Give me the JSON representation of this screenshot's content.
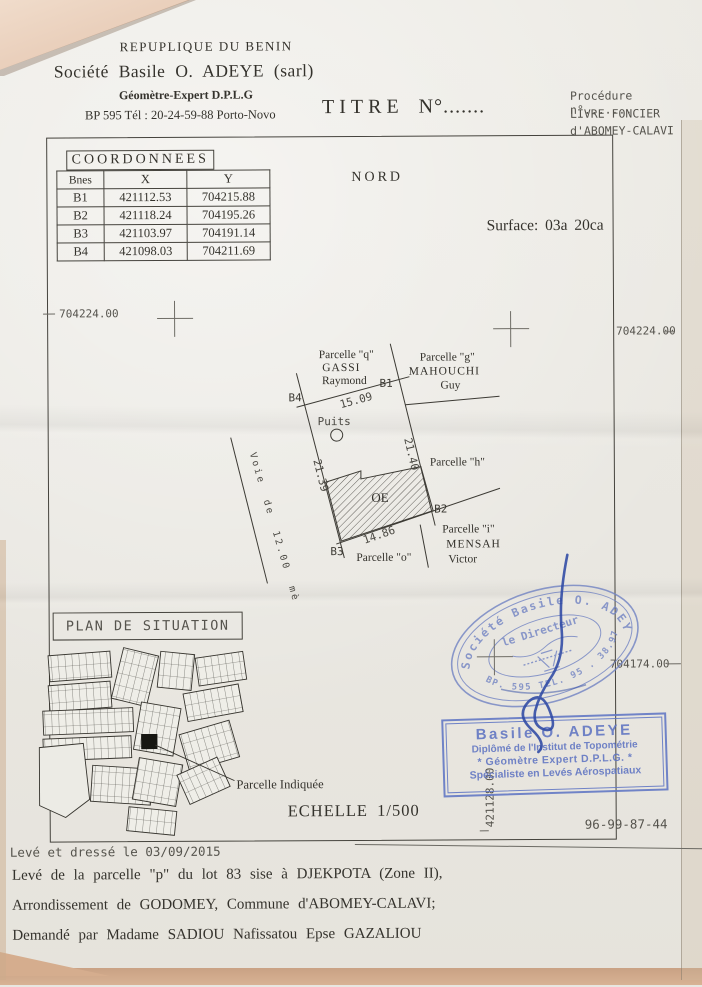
{
  "header": {
    "republic": "REPUPLIQUE DU BENIN",
    "company": "Société Basile O. ADEYE (sarl)",
    "profession": "Géomètre-Expert D.P.L.G",
    "address": "BP 595  Tél : 20-24-59-88  Porto-Novo",
    "title_main": "TITRE",
    "title_no": "N°.......",
    "procedure": "Procédure n°.......",
    "land_book_line1": "LIVRE FONCIER",
    "land_book_line2": "d'ABOMEY-CALAVI"
  },
  "coordinates_table": {
    "title": "COORDONNEES",
    "headers": [
      "Bnes",
      "X",
      "Y"
    ],
    "rows": [
      [
        "B1",
        "421112.53",
        "704215.88"
      ],
      [
        "B2",
        "421118.24",
        "704195.26"
      ],
      [
        "B3",
        "421103.97",
        "704191.14"
      ],
      [
        "B4",
        "421098.03",
        "704211.69"
      ]
    ]
  },
  "survey": {
    "north": "NORD",
    "surface": "Surface: 03a  20ca",
    "grid": {
      "top_left": "704224.00",
      "top_right": "704224.00",
      "mid_right": "704174.00",
      "bottom_vertical": "421128.00"
    },
    "parcel": {
      "b1": "B1",
      "b2": "B2",
      "b3": "B3",
      "b4": "B4",
      "dim_top": "15.09",
      "dim_left": "21.39",
      "dim_right": "21.40",
      "dim_bottom": "14.86",
      "well": "Puits",
      "building": "OE",
      "road": "Voie de 12.00 mètres",
      "neighbor_q": [
        "Parcelle \"q\"",
        "GASSI",
        "Raymond"
      ],
      "neighbor_g": [
        "Parcelle \"g\"",
        "MAHOUCHI",
        "Guy"
      ],
      "neighbor_h": "Parcelle \"h\"",
      "neighbor_i": [
        "Parcelle \"i\"",
        "MENSAH",
        "Victor"
      ],
      "neighbor_o": "Parcelle \"o\""
    }
  },
  "situation": {
    "title": "PLAN DE SITUATION",
    "indicated": "Parcelle Indiquée",
    "scale": "ECHELLE 1/500"
  },
  "reference": "96-99-87-44",
  "stamps": {
    "round": {
      "arc_top": "Société Basile O. ADEYE",
      "center": "le Directeur",
      "arc_bottom": "BP. 595 TEL. 95 . 38.97"
    },
    "rect": {
      "name": "Basile O. ADEYE",
      "line2": "Diplômé de l'Institut de Topométrie",
      "line3": "* Géomètre Expert D.P.L.G. *",
      "line4": "Spécialiste en Levés Aérospatiaux"
    }
  },
  "footer": {
    "line1": "Levé et dressé le 03/09/2015",
    "line2": "Levé de la parcelle \"p\" du lot 83 sise à DJEKPOTA (Zone II),",
    "line3": "Arrondissement de GODOMEY, Commune d'ABOMEY-CALAVI;",
    "line4": "Demandé par Madame SADIOU Nafissatou Epse GAZALIOU"
  },
  "colors": {
    "stamp_blue": "#7183c3",
    "signature_blue": "#2d49a4",
    "ink": "#34322c"
  }
}
